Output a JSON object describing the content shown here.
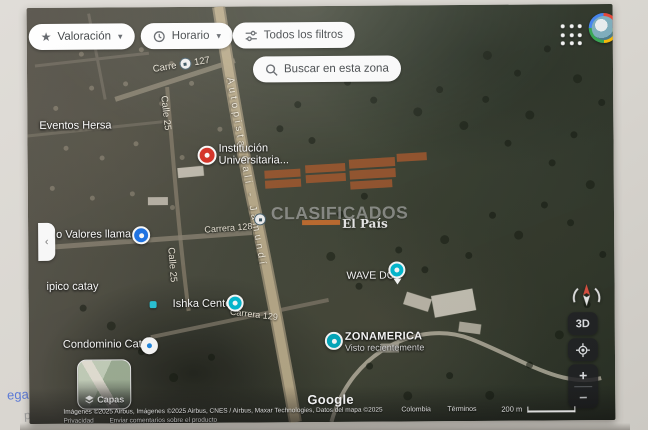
{
  "toolbar": {
    "valoracion": "Valoración",
    "horario": "Horario",
    "todos_los_filtros": "Todos los filtros",
    "buscar": "Buscar en esta zona"
  },
  "poi": {
    "eventos_hersa": "Eventos Hersa",
    "institucion_1": "Institución",
    "institucion_2": "Universitaria...",
    "valores_llama": "o Valores llama",
    "ipico_catay": "ipico catay",
    "ishka_center": "Ishka Center",
    "wave_dc": "WAVE DC",
    "zonamerica": "ZONAMERICA",
    "zonamerica_sub": "Visto recientemente",
    "condominio_catay": "Condominio Catay"
  },
  "roads": {
    "carrera_127_prefix": "Carre",
    "carrera_127_num": "127",
    "calle_25_a": "Calle 25",
    "calle_25_b": "Calle 25",
    "autopista": "Autopista Cali - Jamundí",
    "carrera_128": "Carrera 128",
    "carrera_129": "Carrera 129"
  },
  "watermark": {
    "title": "CLASIFICADOS",
    "brand": "El País"
  },
  "controls": {
    "three_d": "3D",
    "zoom_in": "+",
    "zoom_out": "−",
    "capas": "Capas"
  },
  "footer": {
    "google": "Google",
    "attribution": "Imágenes ©2025 Airbus, Imágenes ©2025 Airbus, CNES / Airbus, Maxar Technologies, Datos del mapa ©2025",
    "region": "Colombia",
    "terminos": "Términos",
    "scale": "200 m",
    "privacidad": "Privacidad",
    "feedback": "Enviar comentarios sobre el producto"
  },
  "bezel": {
    "fragment_link": "egar",
    "fragment_gray": "pa"
  },
  "colors": {
    "marker_red": "#d93025",
    "marker_blue": "#1a73e8",
    "marker_teal": "#00bcd4",
    "road_tan": "#b2a484",
    "watermark_orange": "#d4712b"
  }
}
